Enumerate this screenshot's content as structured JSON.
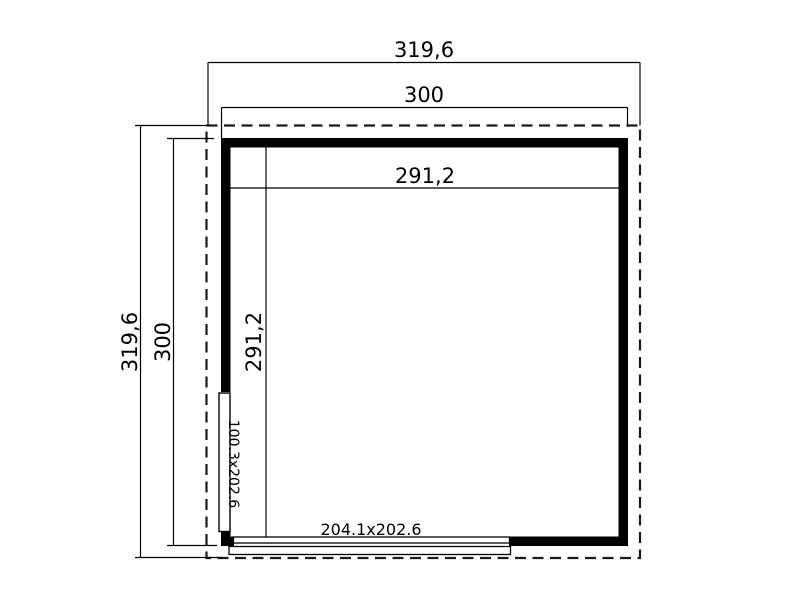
{
  "plan": {
    "colors": {
      "background": "#ffffff",
      "line": "#000000",
      "wall_fill": "#000000",
      "roof_dash": "#1a1a1a"
    },
    "dimensions": {
      "overall_width": "319,6",
      "wall_width": "300",
      "interior_width": "291,2",
      "overall_depth": "319,6",
      "wall_depth": "300",
      "interior_depth": "291,2"
    },
    "openings": {
      "side_door_size": "100.3x202.6",
      "front_door_size": "204.1x202.6"
    }
  }
}
